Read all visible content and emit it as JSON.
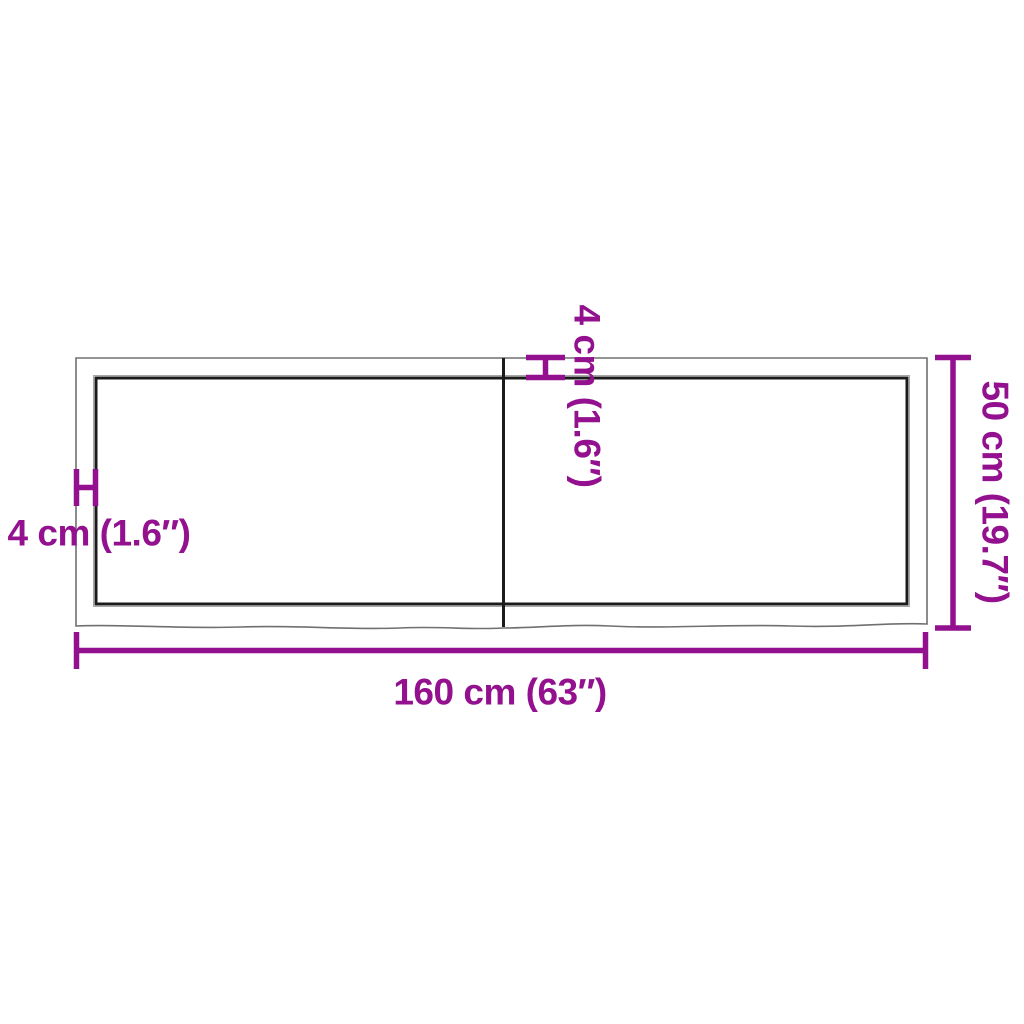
{
  "diagram": {
    "kind": "product-dimension-drawing",
    "subject": "rectangular tabletop with live edge, top view, two panels",
    "labels": {
      "length": "160 cm (63″)",
      "depth": "50 cm (19.7″)",
      "thickness_side": "4 cm (1.6″)",
      "thickness_top": "4 cm (1.6″)"
    },
    "colors": {
      "dimension_accent": "#93108E",
      "outline_outer": "#707072",
      "outline_inner": "#1B1B1B",
      "background": "#FFFFFF"
    }
  }
}
